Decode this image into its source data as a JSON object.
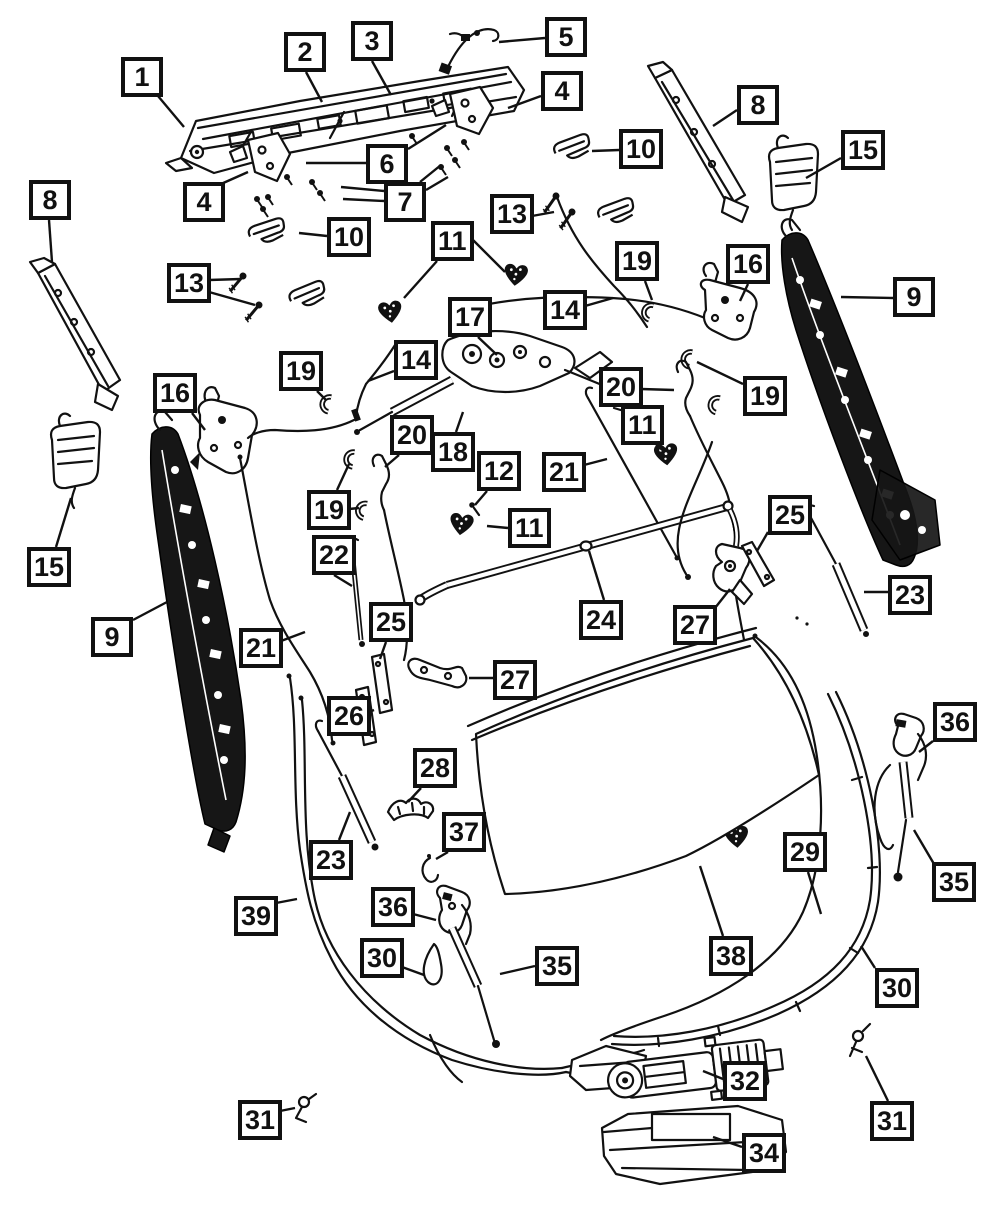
{
  "diagram": {
    "type": "exploded-parts-diagram",
    "colors": {
      "background": "#ffffff",
      "ink": "#111111",
      "callout_border": "#111111",
      "callout_fill": "#ffffff",
      "callout_text": "#111111"
    },
    "callout_count": 60,
    "callouts": [
      {
        "label": "1",
        "x": 121,
        "y": 57,
        "leaders": [
          [
            158,
            96,
            184,
            127
          ]
        ]
      },
      {
        "label": "2",
        "x": 284,
        "y": 32,
        "leaders": [
          [
            306,
            72,
            322,
            102
          ]
        ]
      },
      {
        "label": "3",
        "x": 351,
        "y": 21,
        "leaders": [
          [
            372,
            61,
            391,
            95
          ]
        ]
      },
      {
        "label": "5",
        "x": 545,
        "y": 17,
        "leaders": [
          [
            545,
            38,
            499,
            42
          ]
        ]
      },
      {
        "label": "4",
        "x": 541,
        "y": 71,
        "leaders": [
          [
            541,
            96,
            508,
            108
          ]
        ]
      },
      {
        "label": "8",
        "x": 737,
        "y": 85,
        "leaders": [
          [
            737,
            110,
            713,
            126
          ]
        ]
      },
      {
        "label": "10",
        "x": 619,
        "y": 129,
        "leaders": [
          [
            619,
            150,
            592,
            151
          ]
        ]
      },
      {
        "label": "15",
        "x": 841,
        "y": 130,
        "leaders": [
          [
            841,
            158,
            806,
            178
          ]
        ]
      },
      {
        "label": "6",
        "x": 366,
        "y": 144,
        "leaders": [
          [
            366,
            163,
            306,
            163
          ],
          [
            408,
            149,
            446,
            125
          ]
        ]
      },
      {
        "label": "4",
        "x": 183,
        "y": 182,
        "leaders": [
          [
            221,
            184,
            248,
            172
          ]
        ]
      },
      {
        "label": "7",
        "x": 384,
        "y": 182,
        "leaders": [
          [
            384,
            191,
            341,
            187
          ],
          [
            384,
            201,
            343,
            199
          ],
          [
            420,
            182,
            441,
            165
          ],
          [
            426,
            190,
            448,
            177
          ]
        ]
      },
      {
        "label": "13",
        "x": 490,
        "y": 194,
        "leaders": [
          [
            532,
            216,
            554,
            212
          ]
        ]
      },
      {
        "label": "8",
        "x": 29,
        "y": 180,
        "leaders": [
          [
            49,
            220,
            52,
            262
          ]
        ]
      },
      {
        "label": "10",
        "x": 327,
        "y": 217,
        "leaders": [
          [
            327,
            236,
            299,
            233
          ]
        ]
      },
      {
        "label": "11",
        "x": 431,
        "y": 221,
        "leaders": [
          [
            437,
            261,
            404,
            298
          ],
          [
            473,
            240,
            505,
            272
          ]
        ]
      },
      {
        "label": "13",
        "x": 167,
        "y": 263,
        "leaders": [
          [
            209,
            280,
            241,
            279
          ],
          [
            209,
            292,
            255,
            305
          ]
        ]
      },
      {
        "label": "19",
        "x": 615,
        "y": 241,
        "leaders": [
          [
            645,
            281,
            652,
            300
          ]
        ]
      },
      {
        "label": "16",
        "x": 726,
        "y": 244,
        "leaders": [
          [
            748,
            284,
            740,
            301
          ]
        ]
      },
      {
        "label": "9",
        "x": 893,
        "y": 277,
        "leaders": [
          [
            893,
            298,
            841,
            297
          ]
        ]
      },
      {
        "label": "14",
        "x": 543,
        "y": 290,
        "leaders": [
          [
            585,
            306,
            613,
            298
          ]
        ]
      },
      {
        "label": "17",
        "x": 448,
        "y": 297,
        "leaders": [
          [
            478,
            337,
            497,
            355
          ]
        ]
      },
      {
        "label": "14",
        "x": 394,
        "y": 340,
        "leaders": [
          [
            394,
            371,
            368,
            381
          ]
        ]
      },
      {
        "label": "19",
        "x": 279,
        "y": 351,
        "leaders": [
          [
            317,
            391,
            326,
            400
          ]
        ]
      },
      {
        "label": "16",
        "x": 153,
        "y": 373,
        "leaders": [
          [
            192,
            413,
            205,
            430
          ]
        ]
      },
      {
        "label": "20",
        "x": 599,
        "y": 367,
        "leaders": [
          [
            641,
            389,
            674,
            390
          ]
        ]
      },
      {
        "label": "19",
        "x": 743,
        "y": 376,
        "leaders": [
          [
            743,
            384,
            697,
            362
          ]
        ]
      },
      {
        "label": "11",
        "x": 621,
        "y": 405,
        "leaders": [
          [
            656,
            445,
            664,
            451
          ]
        ]
      },
      {
        "label": "20",
        "x": 390,
        "y": 415,
        "leaders": [
          [
            399,
            455,
            385,
            467
          ]
        ]
      },
      {
        "label": "18",
        "x": 431,
        "y": 432,
        "leaders": [
          [
            456,
            432,
            463,
            412
          ]
        ]
      },
      {
        "label": "12",
        "x": 477,
        "y": 451,
        "leaders": [
          [
            487,
            491,
            475,
            505
          ]
        ]
      },
      {
        "label": "21",
        "x": 542,
        "y": 452,
        "leaders": [
          [
            584,
            465,
            607,
            459
          ]
        ]
      },
      {
        "label": "11",
        "x": 508,
        "y": 508,
        "leaders": [
          [
            508,
            528,
            487,
            526
          ]
        ]
      },
      {
        "label": "19",
        "x": 307,
        "y": 490,
        "leaders": [
          [
            337,
            490,
            349,
            464
          ],
          [
            349,
            509,
            359,
            508
          ]
        ]
      },
      {
        "label": "22",
        "x": 312,
        "y": 535,
        "leaders": [
          [
            334,
            575,
            352,
            586
          ]
        ]
      },
      {
        "label": "25",
        "x": 768,
        "y": 495,
        "leaders": [
          [
            768,
            532,
            757,
            551
          ]
        ]
      },
      {
        "label": "15",
        "x": 27,
        "y": 547,
        "leaders": [
          [
            56,
            547,
            71,
            498
          ]
        ]
      },
      {
        "label": "23",
        "x": 888,
        "y": 575,
        "leaders": [
          [
            888,
            592,
            864,
            592
          ]
        ]
      },
      {
        "label": "24",
        "x": 579,
        "y": 600,
        "leaders": [
          [
            604,
            600,
            589,
            551
          ]
        ]
      },
      {
        "label": "27",
        "x": 673,
        "y": 605,
        "leaders": [
          [
            715,
            608,
            730,
            589
          ]
        ]
      },
      {
        "label": "25",
        "x": 369,
        "y": 602,
        "leaders": [
          [
            386,
            642,
            380,
            659
          ]
        ]
      },
      {
        "label": "9",
        "x": 91,
        "y": 617,
        "leaders": [
          [
            133,
            620,
            167,
            602
          ]
        ]
      },
      {
        "label": "21",
        "x": 239,
        "y": 628,
        "leaders": [
          [
            281,
            641,
            305,
            632
          ]
        ]
      },
      {
        "label": "26",
        "x": 327,
        "y": 696,
        "leaders": [
          [
            369,
            712,
            374,
            710
          ]
        ]
      },
      {
        "label": "27",
        "x": 493,
        "y": 660,
        "leaders": [
          [
            493,
            678,
            469,
            678
          ]
        ]
      },
      {
        "label": "28",
        "x": 413,
        "y": 748,
        "leaders": [
          [
            421,
            788,
            408,
            802
          ]
        ]
      },
      {
        "label": "37",
        "x": 442,
        "y": 812,
        "leaders": [
          [
            448,
            852,
            436,
            859
          ]
        ]
      },
      {
        "label": "23",
        "x": 309,
        "y": 840,
        "leaders": [
          [
            339,
            840,
            350,
            812
          ]
        ]
      },
      {
        "label": "39",
        "x": 234,
        "y": 896,
        "leaders": [
          [
            276,
            903,
            297,
            899
          ]
        ]
      },
      {
        "label": "36",
        "x": 371,
        "y": 887,
        "leaders": [
          [
            413,
            914,
            436,
            920
          ]
        ]
      },
      {
        "label": "30",
        "x": 360,
        "y": 938,
        "leaders": [
          [
            402,
            967,
            424,
            975
          ]
        ]
      },
      {
        "label": "35",
        "x": 535,
        "y": 946,
        "leaders": [
          [
            535,
            966,
            500,
            974
          ]
        ]
      },
      {
        "label": "38",
        "x": 709,
        "y": 936,
        "leaders": [
          [
            723,
            936,
            700,
            866
          ]
        ]
      },
      {
        "label": "29",
        "x": 783,
        "y": 832,
        "leaders": [
          [
            808,
            872,
            821,
            914
          ]
        ]
      },
      {
        "label": "36",
        "x": 933,
        "y": 702,
        "leaders": [
          [
            933,
            741,
            919,
            752
          ]
        ]
      },
      {
        "label": "35",
        "x": 932,
        "y": 862,
        "leaders": [
          [
            934,
            864,
            914,
            830
          ]
        ]
      },
      {
        "label": "30",
        "x": 875,
        "y": 968,
        "leaders": [
          [
            875,
            968,
            861,
            946
          ]
        ]
      },
      {
        "label": "32",
        "x": 723,
        "y": 1061,
        "leaders": [
          [
            723,
            1079,
            703,
            1071
          ]
        ]
      },
      {
        "label": "34",
        "x": 742,
        "y": 1133,
        "leaders": [
          [
            742,
            1147,
            713,
            1137
          ]
        ]
      },
      {
        "label": "31",
        "x": 870,
        "y": 1101,
        "leaders": [
          [
            888,
            1101,
            866,
            1056
          ]
        ]
      },
      {
        "label": "31",
        "x": 238,
        "y": 1100,
        "leaders": [
          [
            280,
            1111,
            295,
            1108
          ]
        ]
      }
    ]
  }
}
